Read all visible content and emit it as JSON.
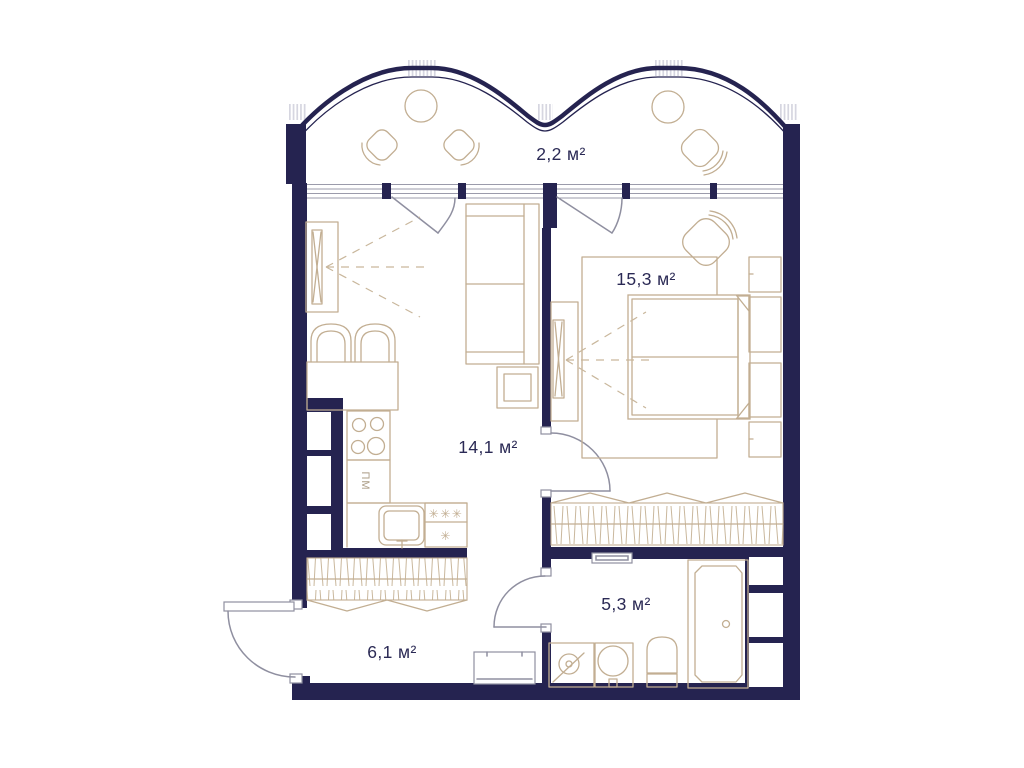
{
  "plan": {
    "type": "apartment-floor-plan",
    "rooms": [
      {
        "id": "balcony",
        "label": "2,2 м²"
      },
      {
        "id": "bedroom",
        "label": "15,3 м²"
      },
      {
        "id": "living-kitchen",
        "label": "14,1 м²"
      },
      {
        "id": "bathroom",
        "label": "5,3 м²"
      },
      {
        "id": "hallway",
        "label": "6,1 м²"
      }
    ],
    "kitchen": {
      "dishwasher_label": "ПМ",
      "freezer_stars": "✳✳✳",
      "fridge_star": "✳"
    },
    "colors": {
      "wall": "#252350",
      "furniture_outline": "#c2ae92",
      "door_gray": "#8f8fa0",
      "hatch_mark": "#d6d6e0",
      "label_text": "#2b2a55",
      "background": "#ffffff"
    }
  }
}
